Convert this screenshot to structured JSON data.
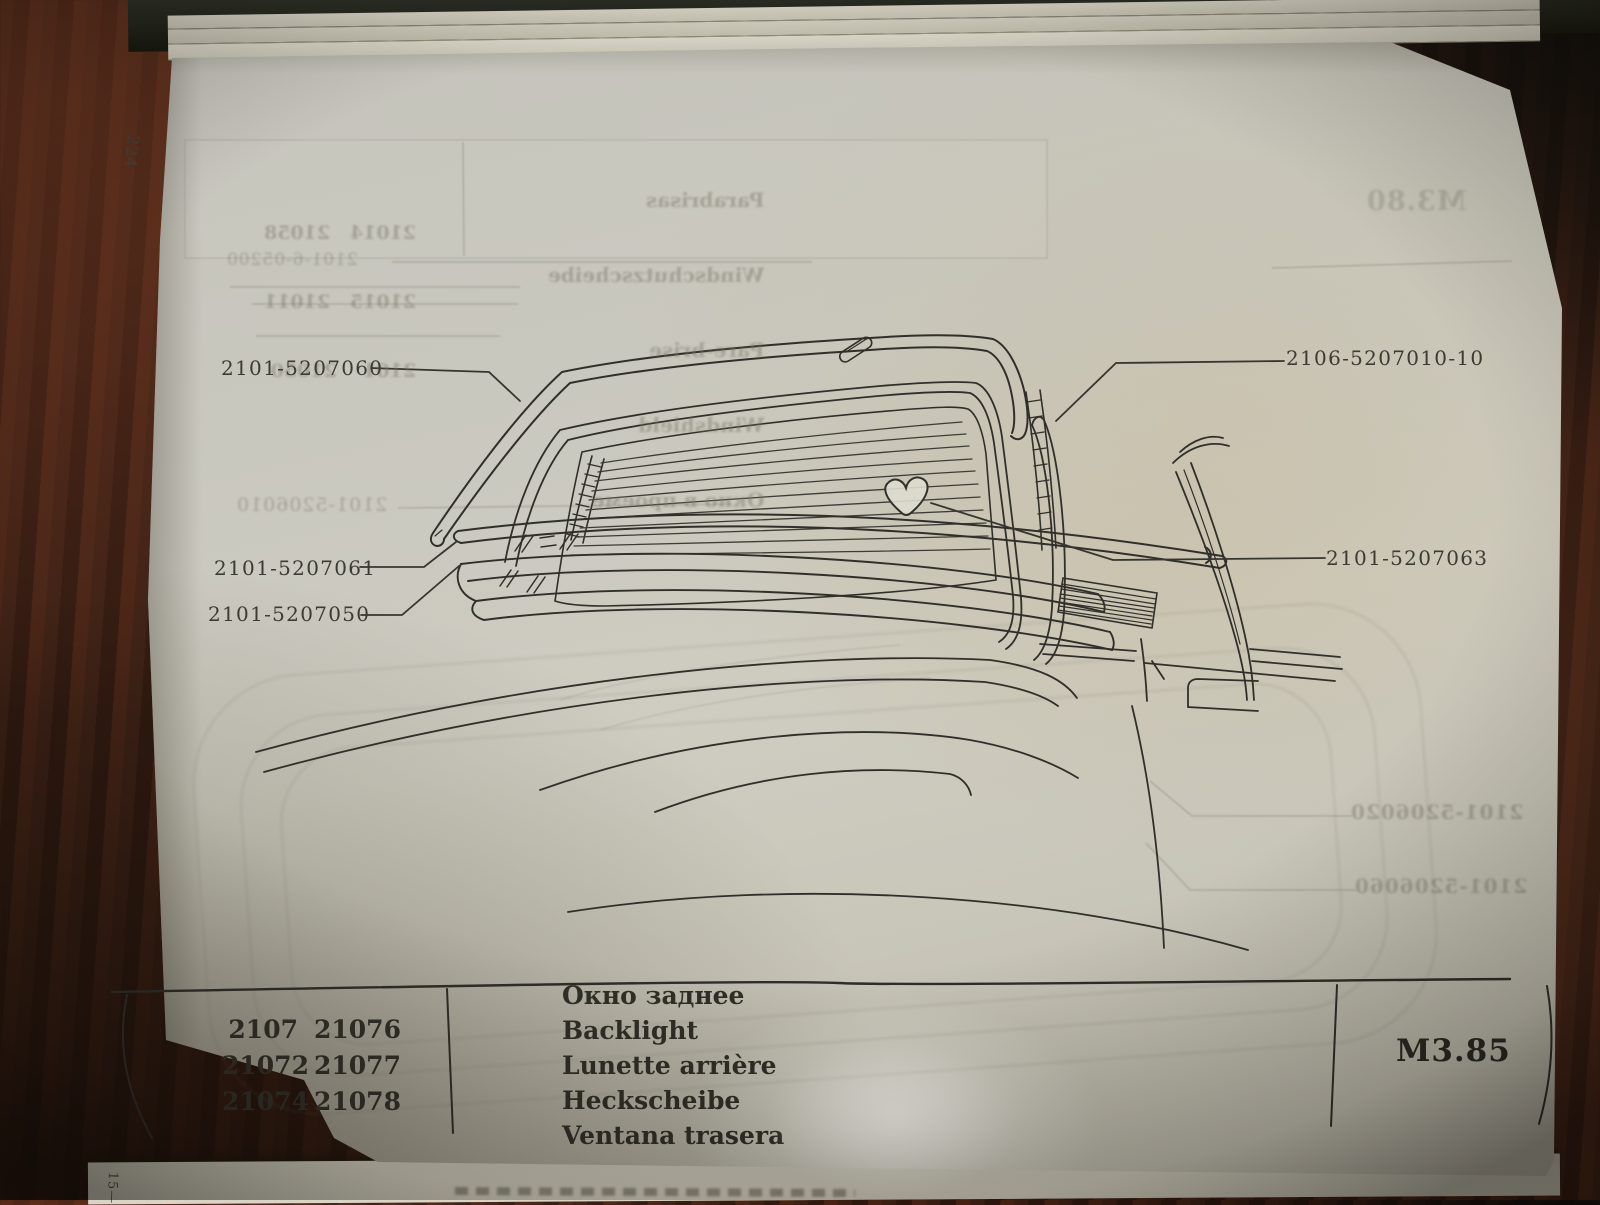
{
  "page": {
    "number": "224",
    "signature_mark": "15—"
  },
  "diagram": {
    "part_labels": {
      "molding_top": "2101-5207060",
      "molding_lower": "2101-5207061",
      "molding_frame": "2101-5207050",
      "seal": "2106-5207010-10",
      "clip": "2101-5207063"
    }
  },
  "footer": {
    "model_numbers": [
      [
        "2107",
        "21076"
      ],
      [
        "21072",
        "21077"
      ],
      [
        "21074",
        "21078"
      ]
    ],
    "part_names": [
      "Окно заднее",
      "Backlight",
      "Lunette arrière",
      "Heckscheibe",
      "Ventana trasera"
    ],
    "section_code": "M3.85"
  },
  "show_through": {
    "section_code": "M3.80",
    "table_number_rows": [
      "21014   21058",
      "21015   21011",
      "2101    21050"
    ],
    "table_names": [
      "Parabrisas",
      "Windschutzscheibe",
      "Pare-brise",
      "Windshield",
      "Окно в проеме"
    ],
    "part_labels": [
      "2101-5206010",
      "2101-6-05200",
      "2101-5206020",
      "2101-5206060"
    ]
  }
}
